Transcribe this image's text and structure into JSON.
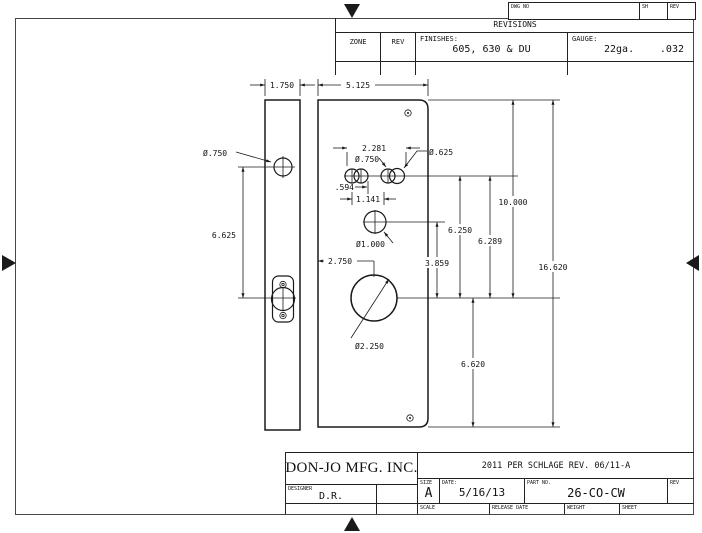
{
  "frame": {
    "strip": {
      "dwg_no": "DWG NO",
      "sh": "SH",
      "rev": "REV"
    }
  },
  "revisions": {
    "title": "REVISIONS",
    "zone": "ZONE",
    "rev": "REV",
    "finishes_label": "FINISHES:",
    "finishes_value": "605, 630 & DU",
    "gauge_label": "GAUGE:",
    "gauge_thickness": "22ga.",
    "gauge_decimal": ".032"
  },
  "title_block": {
    "company": "DON-JO MFG. INC.",
    "designer_label": "DESIGNER",
    "designer": "D.R.",
    "note": "2011 PER SCHLAGE REV. 06/11-A",
    "size_label": "SIZE",
    "size": "A",
    "date_label": "DATE:",
    "date": "5/16/13",
    "part_label": "PART NO.",
    "part": "26-CO-CW",
    "rev_label": "REV",
    "scale_label": "SCALE",
    "release_label": "RELEASE DATE",
    "weight_label": "WEIGHT",
    "sheet_label": "SHEET"
  },
  "dims": {
    "side_width": "1.750",
    "main_width": "5.125",
    "side_hole": "Ø.750",
    "side_span": "6.625",
    "top_span": "2.281",
    "top_hole": "Ø.750",
    "top_hole_b": "Ø.625",
    "off_a": ".594",
    "off_b": "1.141",
    "mid_hole": "Ø1.000",
    "cyl_off": "2.750",
    "cyl_hole": "Ø2.250",
    "mid_to_cyl": "3.859",
    "top_to_cyl_a": "6.250",
    "top_to_cyl_b": "6.289",
    "edge_to_cyl": "10.000",
    "plate_height": "16.620",
    "cyl_to_bottom": "6.620"
  }
}
